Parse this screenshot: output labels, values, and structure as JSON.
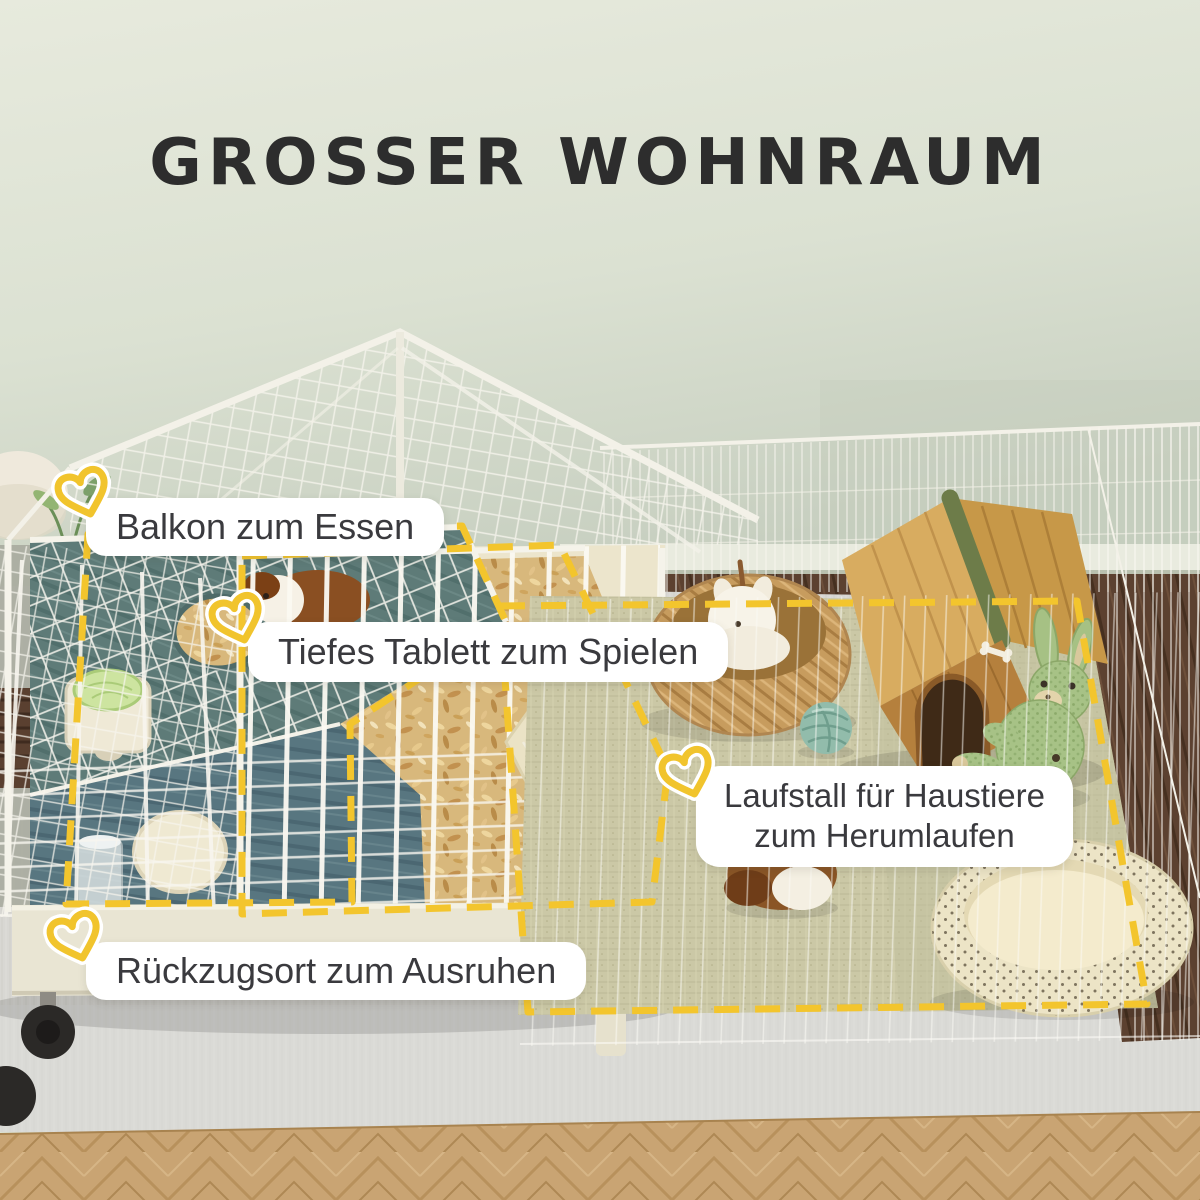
{
  "title": "GROSSER WOHNRAUM",
  "callouts": {
    "balcony": {
      "text": "Balkon zum Essen"
    },
    "tray": {
      "text": "Tiefes Tablett zum Spielen"
    },
    "playpen": {
      "line1": "Laufstall für Haustiere",
      "line2": "zum Herumlaufen"
    },
    "retreat": {
      "text": "Rückzugsort zum Ausruhen"
    }
  },
  "colors": {
    "accent_yellow": "#F3C52D",
    "title_text": "#2D2D2D",
    "label_text": "#3A3A3E",
    "label_background": "#FFFFFF",
    "wall_green": "#DDE3D4",
    "balcony_teal": "#5E7B78",
    "bedding_tan": "#D8B87C",
    "mat_beige": "#CBC8A6",
    "rug_gray": "#D8D7D3",
    "wood_floor": "#C9A473",
    "dark_wood": "#5C4130"
  },
  "scene": {
    "description": "Small-animal cage with eating balcony and deep bedding tray, connected to a wire playpen on a rug",
    "objects": [
      "wire cage with mesh roof",
      "teal balcony tray",
      "deep bedding tray with shavings",
      "guinea pig in cage",
      "food bowl with lettuce",
      "water bottle",
      "hideout opening",
      "open cage door ramp",
      "cage base with caster wheels",
      "wire playpen fence",
      "woven floor mat",
      "wicker basket with plush toy",
      "wooden pet house with green ridge",
      "knitted bunny plush",
      "teal yarn ball",
      "guinea pig in playpen",
      "woven pet bed",
      "potted plant",
      "gray rug",
      "herringbone parquet floor"
    ]
  }
}
